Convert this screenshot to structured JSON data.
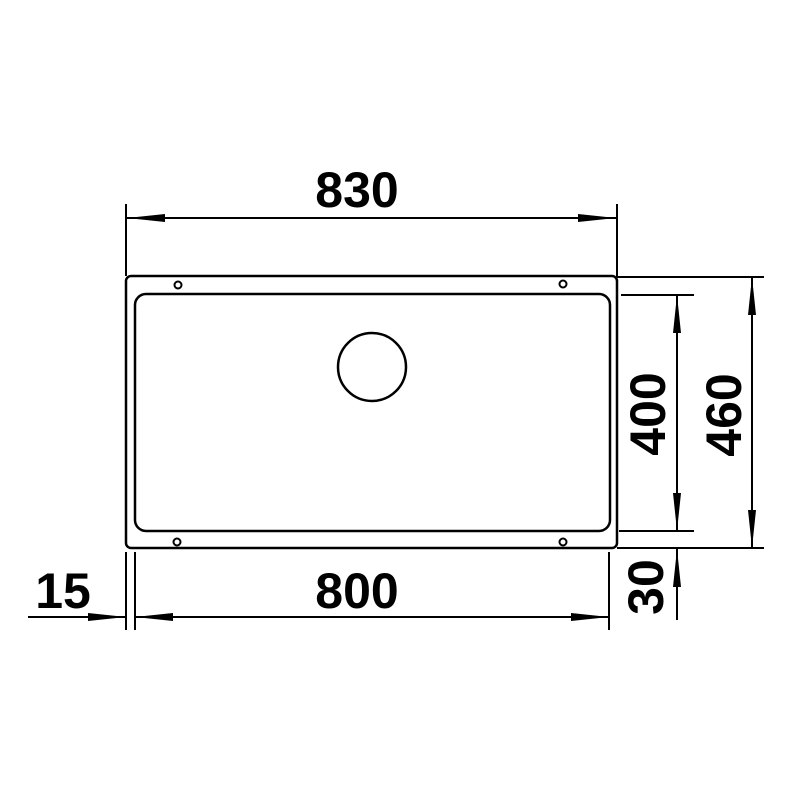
{
  "drawing": {
    "type": "technical dimension drawing",
    "subject": "undermount sink, top view",
    "unit": "mm",
    "line_color": "#000000",
    "background_color": "#ffffff",
    "labels": {
      "overall_width": "830",
      "overall_depth": "460",
      "bowl_width": "800",
      "bowl_depth": "400",
      "flange_offset_left": "15",
      "flange_offset_bottom": "30"
    }
  }
}
